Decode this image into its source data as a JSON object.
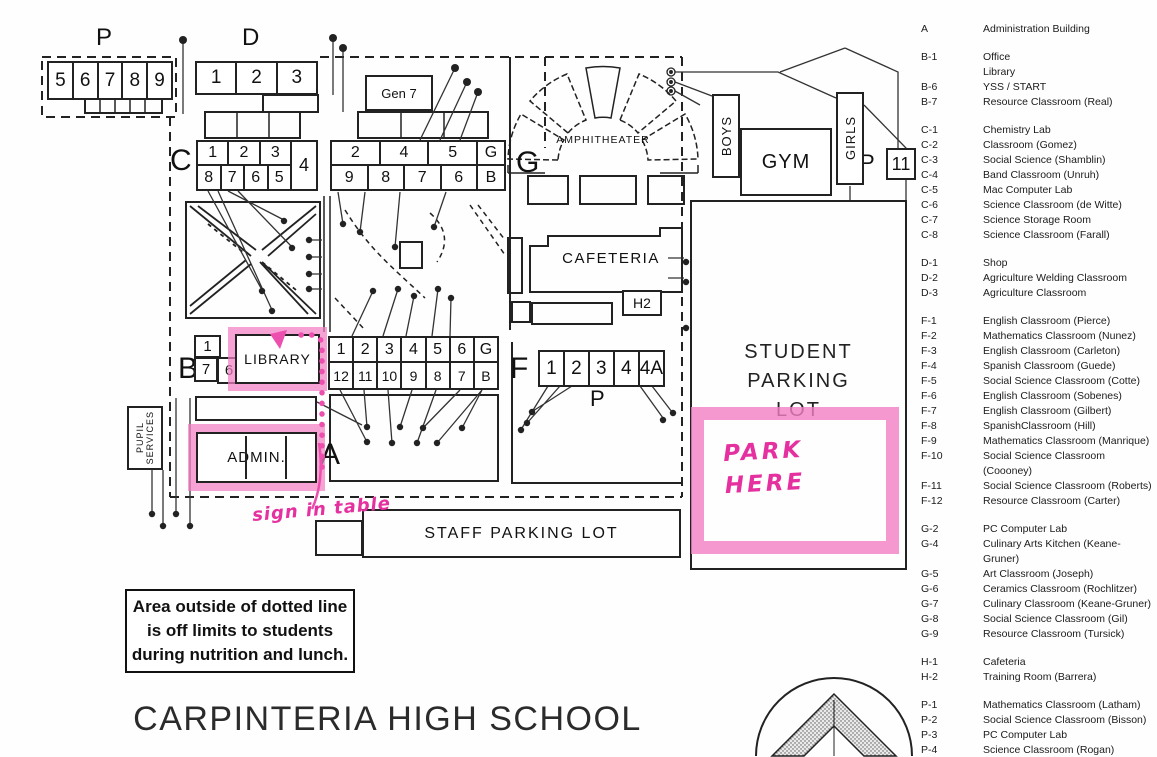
{
  "title": "CARPINTERIA HIGH SCHOOL",
  "note_box": {
    "lines": [
      "Area outside of dotted line",
      "is off limits to students",
      "during nutrition and lunch."
    ]
  },
  "annotations": {
    "park_here": [
      "PARK",
      "HERE"
    ],
    "sign_in_table": "sign in table"
  },
  "colors": {
    "highlighter_pink": "#f37ec4",
    "handwriting_pink": "#e5309f",
    "ink": "#222222",
    "paper": "#fefefe"
  },
  "icons": {
    "compass": "compass-rose-icon"
  },
  "map": {
    "section_letters": {
      "p_northwest": "P",
      "d": "D",
      "c": "C",
      "g_big": "G",
      "b": "B",
      "f": "F",
      "a": "A",
      "p_portables": "P",
      "p_gym": "P"
    },
    "buildings": {
      "gen7": "Gen 7",
      "amphitheater": "AMPHITHEATER",
      "boys": "BOYS",
      "gym": "GYM",
      "girls": "GIRLS",
      "p11": "11",
      "cafeteria": "CAFETERIA",
      "h2": "H2",
      "library": "LIBRARY",
      "admin": "ADMIN.",
      "pupil_services": [
        "PUPIL",
        "SERVICES"
      ],
      "staff_lot": "STAFF PARKING LOT",
      "student_lot": [
        "STUDENT",
        "PARKING",
        "LOT"
      ]
    },
    "rooms": {
      "p_northwest": [
        "5",
        "6",
        "7",
        "8",
        "9"
      ],
      "d": [
        "1",
        "2",
        "3"
      ],
      "c_top": [
        "1",
        "2",
        "3"
      ],
      "c_right": "4",
      "c_bottom": [
        "8",
        "7",
        "6",
        "5"
      ],
      "g_top": [
        "2",
        "4",
        "5",
        "G"
      ],
      "g_bottom": [
        "9",
        "8",
        "7",
        "6",
        "B"
      ],
      "f_top": [
        "1",
        "2",
        "3",
        "4",
        "5",
        "6",
        "G"
      ],
      "f_bottom": [
        "12",
        "11",
        "10",
        "9",
        "8",
        "7",
        "B"
      ],
      "b_top": "1",
      "b_left": "7",
      "b_right": "6",
      "p_portables": [
        "1",
        "2",
        "3",
        "4",
        "4A"
      ]
    }
  },
  "legend": {
    "groups": [
      [
        {
          "code": "A",
          "label": "Administration Building"
        }
      ],
      [
        {
          "code": "B-1",
          "label": "Office"
        },
        {
          "code": "",
          "label": "Library"
        },
        {
          "code": "B-6",
          "label": "YSS / START"
        },
        {
          "code": "B-7",
          "label": "Resource Classroom (Real)"
        }
      ],
      [
        {
          "code": "C-1",
          "label": "Chemistry Lab"
        },
        {
          "code": "C-2",
          "label": "Classroom (Gomez)"
        },
        {
          "code": "C-3",
          "label": "Social Science (Shamblin)"
        },
        {
          "code": "C-4",
          "label": "Band Classroom (Unruh)"
        },
        {
          "code": "C-5",
          "label": "Mac Computer Lab"
        },
        {
          "code": "C-6",
          "label": "Science Classroom (de Witte)"
        },
        {
          "code": "C-7",
          "label": "Science Storage Room"
        },
        {
          "code": "C-8",
          "label": "Science Classroom (Farall)"
        }
      ],
      [
        {
          "code": "D-1",
          "label": "Shop"
        },
        {
          "code": "D-2",
          "label": "Agriculture Welding Classroom"
        },
        {
          "code": "D-3",
          "label": "Agriculture Classroom"
        }
      ],
      [
        {
          "code": "F-1",
          "label": "English Classroom (Pierce)"
        },
        {
          "code": "F-2",
          "label": "Mathematics Classroom (Nunez)"
        },
        {
          "code": "F-3",
          "label": "English Classroom (Carleton)"
        },
        {
          "code": "F-4",
          "label": "Spanish Classroom (Guede)"
        },
        {
          "code": "F-5",
          "label": "Social Science Classroom (Cotte)"
        },
        {
          "code": "F-6",
          "label": "English Classroom (Sobenes)"
        },
        {
          "code": "F-7",
          "label": "English Classroom (Gilbert)"
        },
        {
          "code": "F-8",
          "label": "SpanishClassroom (Hill)"
        },
        {
          "code": "F-9",
          "label": "Mathematics Classroom (Manrique)"
        },
        {
          "code": "F-10",
          "label": "Social Science Classroom (Coooney)"
        },
        {
          "code": "F-11",
          "label": "Social Science Classroom (Roberts)"
        },
        {
          "code": "F-12",
          "label": "Resource Classroom (Carter)"
        }
      ],
      [
        {
          "code": "G-2",
          "label": "PC Computer Lab"
        },
        {
          "code": "G-4",
          "label": "Culinary Arts Kitchen (Keane-Gruner)"
        },
        {
          "code": "G-5",
          "label": "Art Classroom (Joseph)"
        },
        {
          "code": "G-6",
          "label": "Ceramics Classroom (Rochlitzer)"
        },
        {
          "code": "G-7",
          "label": "Culinary Classroom (Keane-Gruner)"
        },
        {
          "code": "G-8",
          "label": "Social Science Classroom (Gil)"
        },
        {
          "code": "G-9",
          "label": "Resource Classroom (Tursick)"
        }
      ],
      [
        {
          "code": "H-1",
          "label": "Cafeteria"
        },
        {
          "code": "H-2",
          "label": "Training Room (Barrera)"
        }
      ],
      [
        {
          "code": "P-1",
          "label": "Mathematics Classroom (Latham)"
        },
        {
          "code": "P-2",
          "label": "Social Science Classroom (Bisson)"
        },
        {
          "code": "P-3",
          "label": "PC Computer Lab"
        },
        {
          "code": "P-4",
          "label": "Science Classroom (Rogan)"
        }
      ]
    ]
  }
}
